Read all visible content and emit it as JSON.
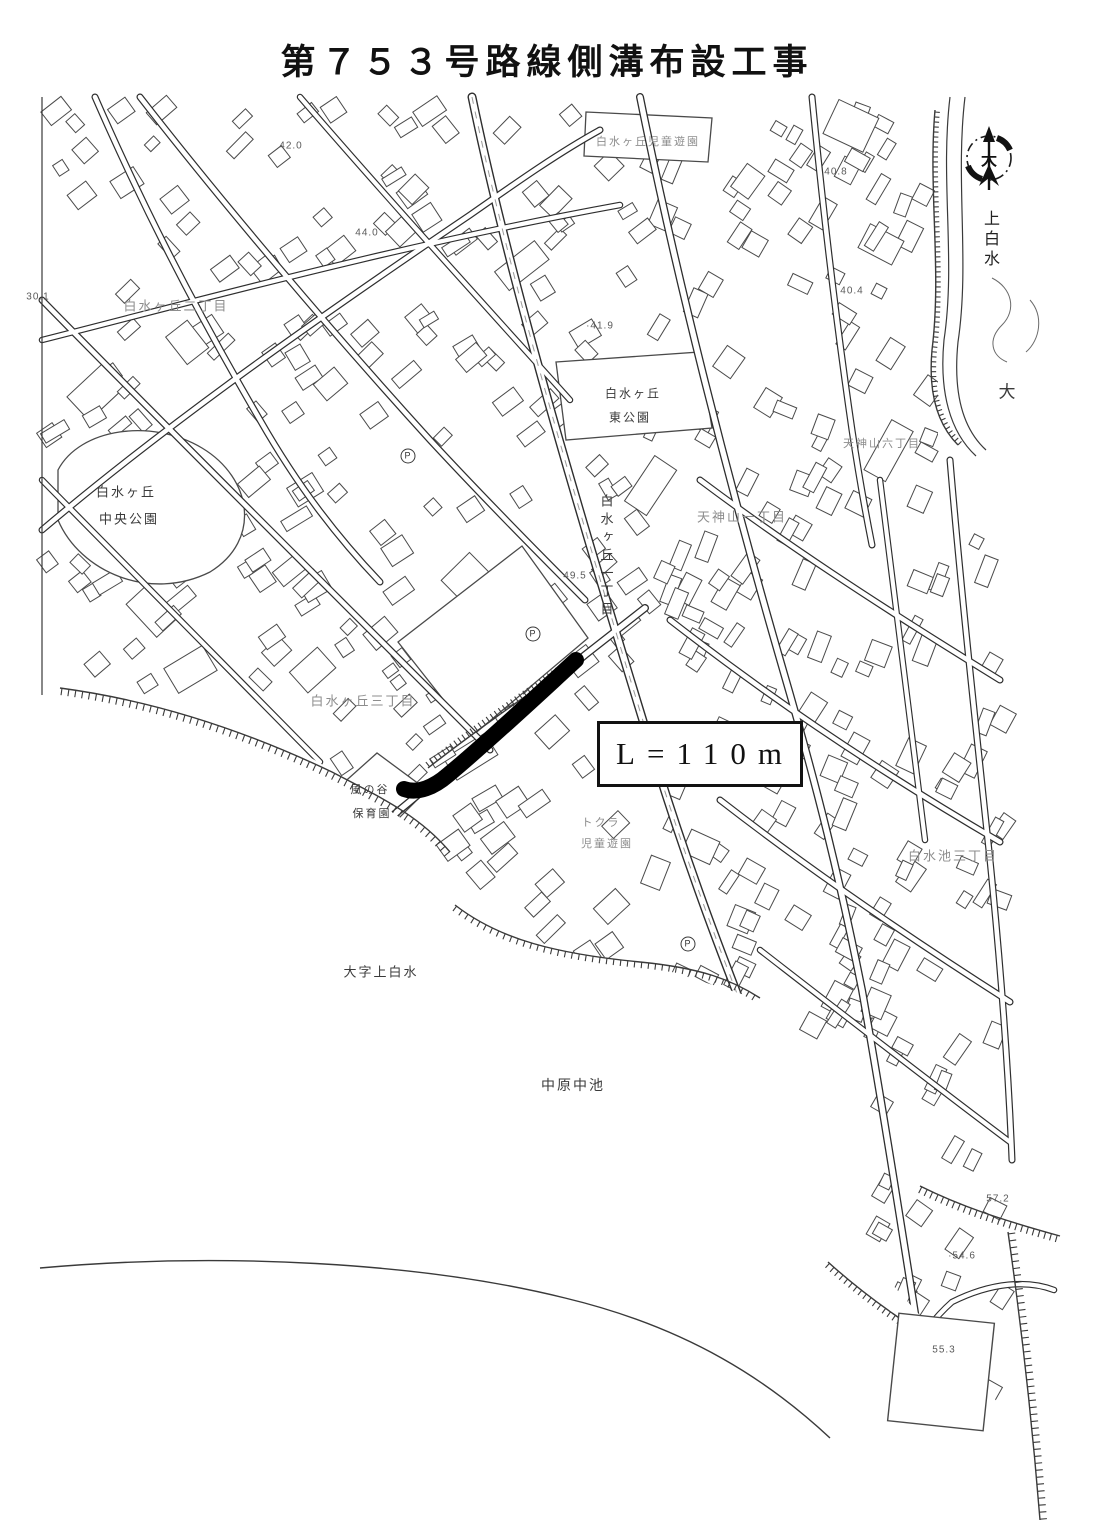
{
  "title": "第７５３号路線側溝布設工事",
  "route": {
    "length_label": "L=110m"
  },
  "compass": {
    "center_char": "大",
    "below_vertical": "上白水"
  },
  "colors": {
    "ink": "#2f2f2f",
    "route": "#000000",
    "faint": "#8d8d8d",
    "paper": "#ffffff"
  },
  "map_labels": [
    {
      "text": "白水ヶ丘児童遊園",
      "x": 648,
      "y": 141,
      "size": 11,
      "faint": true
    },
    {
      "text": "白水ヶ丘二丁目",
      "x": 176,
      "y": 305,
      "size": 13,
      "faint": true
    },
    {
      "text": "白水ヶ丘",
      "x": 126,
      "y": 491,
      "size": 13,
      "faint": false
    },
    {
      "text": "中央公園",
      "x": 129,
      "y": 518,
      "size": 13,
      "faint": false
    },
    {
      "text": "白水ヶ丘",
      "x": 633,
      "y": 393,
      "size": 12,
      "faint": false
    },
    {
      "text": "東公園",
      "x": 630,
      "y": 417,
      "size": 12,
      "faint": false
    },
    {
      "text": "白水ヶ丘一丁目",
      "x": 606,
      "y": 557,
      "size": 13,
      "faint": false,
      "vertical": true
    },
    {
      "text": "天神山一丁目",
      "x": 742,
      "y": 516,
      "size": 13,
      "faint": true
    },
    {
      "text": "天神山六丁目",
      "x": 882,
      "y": 443,
      "size": 11,
      "faint": true
    },
    {
      "text": "白水ヶ丘三丁目",
      "x": 363,
      "y": 700,
      "size": 13,
      "faint": true
    },
    {
      "text": "風の谷",
      "x": 370,
      "y": 789,
      "size": 11,
      "faint": false
    },
    {
      "text": "保育園",
      "x": 372,
      "y": 813,
      "size": 11,
      "faint": false
    },
    {
      "text": "トクラ",
      "x": 601,
      "y": 822,
      "size": 11,
      "faint": true
    },
    {
      "text": "児童遊園",
      "x": 607,
      "y": 843,
      "size": 11,
      "faint": true
    },
    {
      "text": "白水池三丁目",
      "x": 953,
      "y": 855,
      "size": 13,
      "faint": true
    },
    {
      "text": "大字上白水",
      "x": 381,
      "y": 971,
      "size": 13,
      "faint": false
    },
    {
      "text": "中原中池",
      "x": 573,
      "y": 1085,
      "size": 14,
      "faint": false
    },
    {
      "text": "大",
      "x": 1008,
      "y": 390,
      "size": 17,
      "faint": false
    }
  ],
  "elevation_marks": [
    {
      "text": "42.0",
      "x": 291,
      "y": 146
    },
    {
      "text": "44.0",
      "x": 367,
      "y": 233
    },
    {
      "text": "·41.9",
      "x": 600,
      "y": 326
    },
    {
      "text": "40.8",
      "x": 836,
      "y": 172
    },
    {
      "text": "40.4",
      "x": 852,
      "y": 291
    },
    {
      "text": "49.5",
      "x": 575,
      "y": 576
    },
    {
      "text": "30.1",
      "x": 38,
      "y": 297
    },
    {
      "text": "57.2",
      "x": 998,
      "y": 1199
    },
    {
      "text": "·54.6",
      "x": 962,
      "y": 1256
    },
    {
      "text": "55.3",
      "x": 944,
      "y": 1350
    }
  ],
  "symbols": [
    {
      "glyph": "P",
      "x": 408,
      "y": 456
    },
    {
      "glyph": "P",
      "x": 533,
      "y": 634
    },
    {
      "glyph": "P",
      "x": 688,
      "y": 944
    }
  ]
}
